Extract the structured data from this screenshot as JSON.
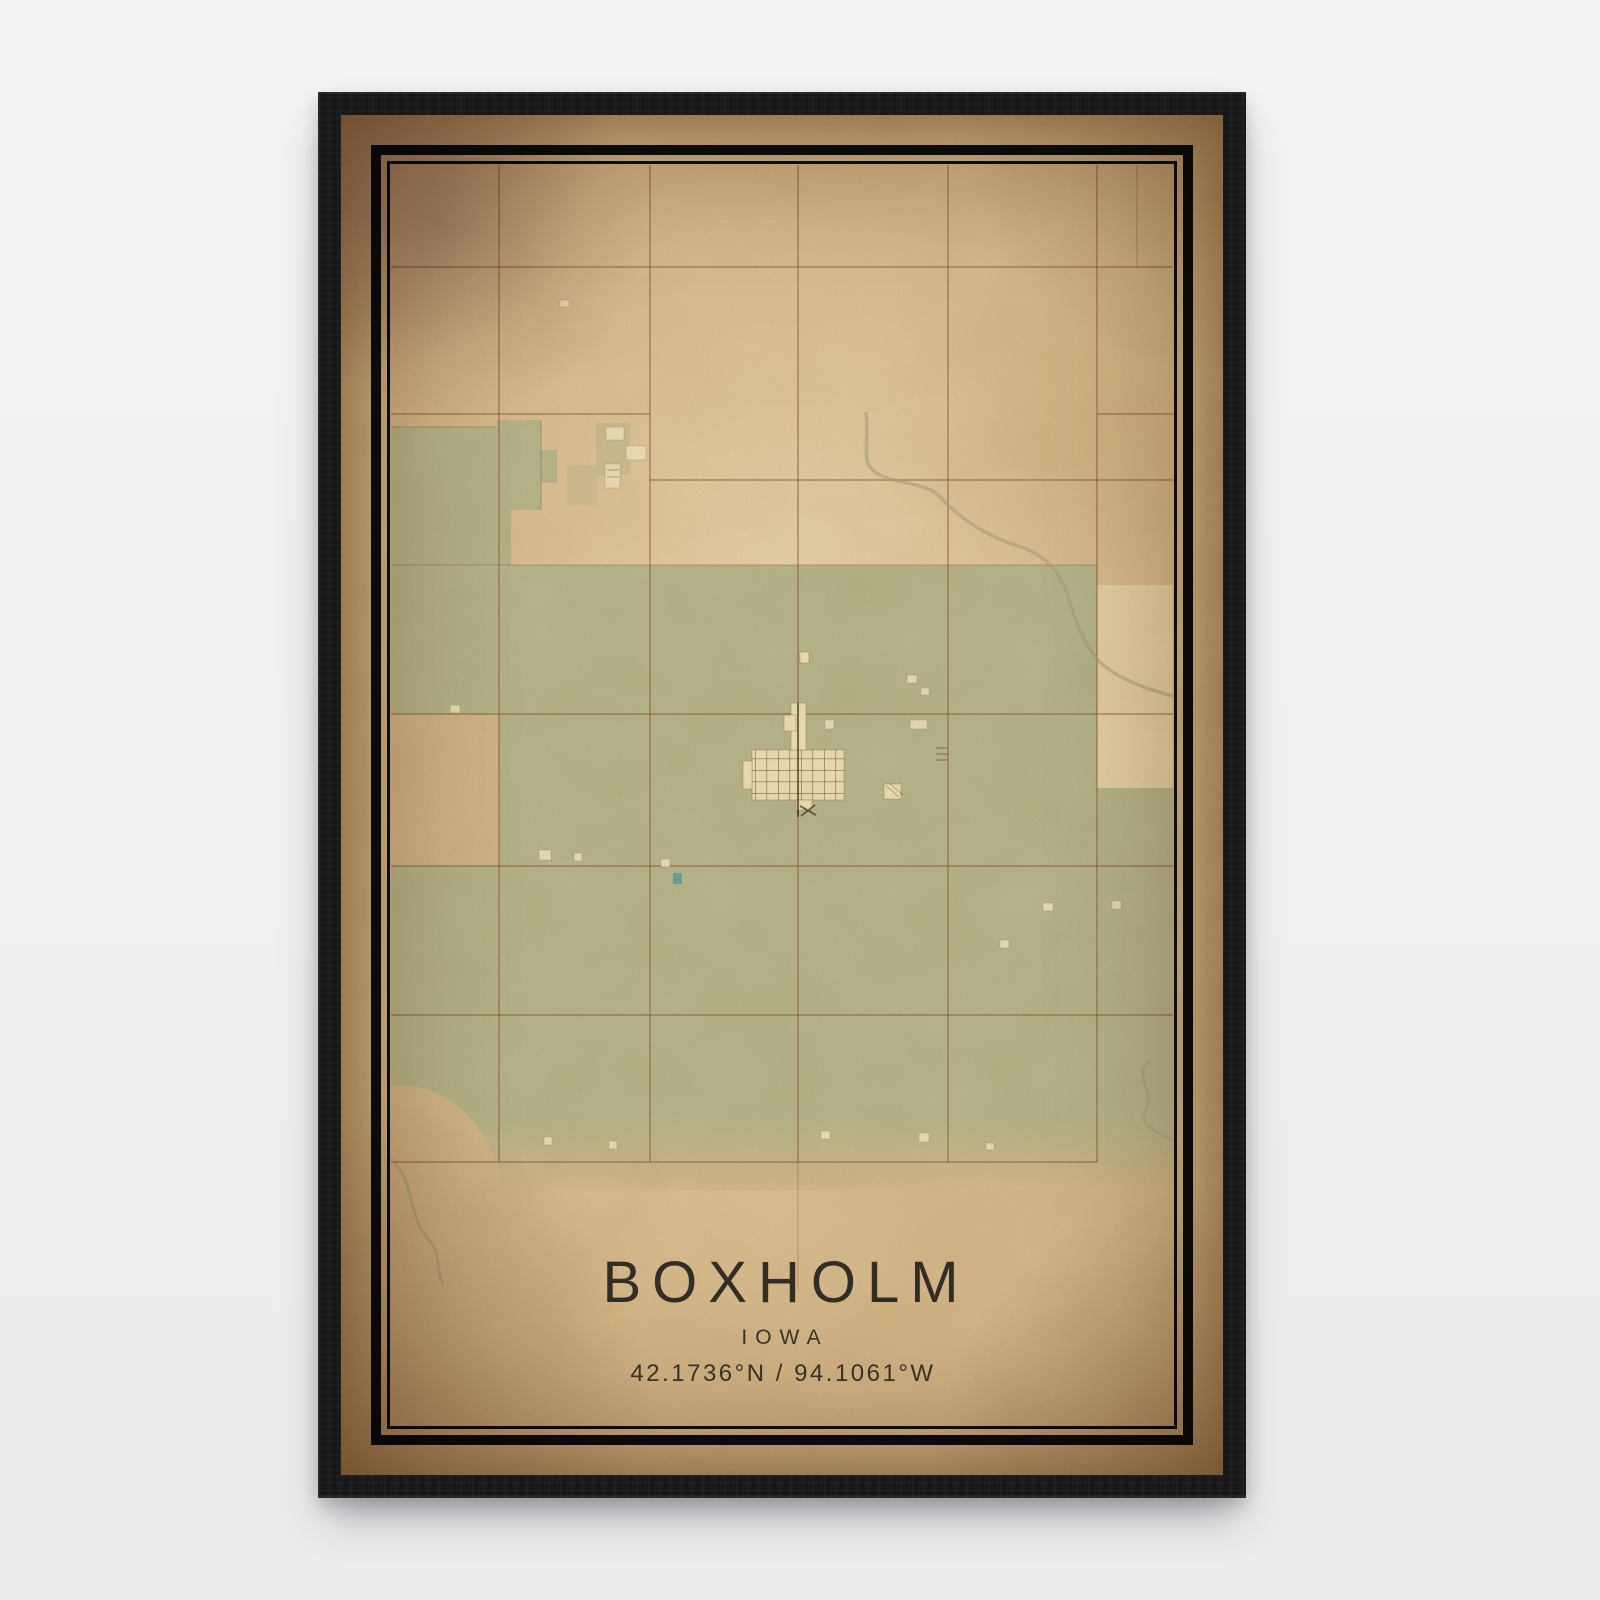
{
  "poster": {
    "city": "BOXHOLM",
    "state": "IOWA",
    "coordinates": "42.1736°N / 94.1061°W",
    "latitude": "42.1736°N",
    "longitude": "94.1061°W"
  },
  "frame": {
    "style": "black wood frame with double black keyline border on aged paper"
  },
  "colors": {
    "frame": "#17191b",
    "paper": "#d8bb8c",
    "paper-bright": "#e9d6ab",
    "map-green": "#b9b88e",
    "road": "#8a5030",
    "town": "#efe0b6",
    "street": "#4b3626",
    "creek": "#a8a27f",
    "pond": "#63a096",
    "ink": "#26241f",
    "border": "#0d0d0d",
    "background": "#eef0f1"
  }
}
